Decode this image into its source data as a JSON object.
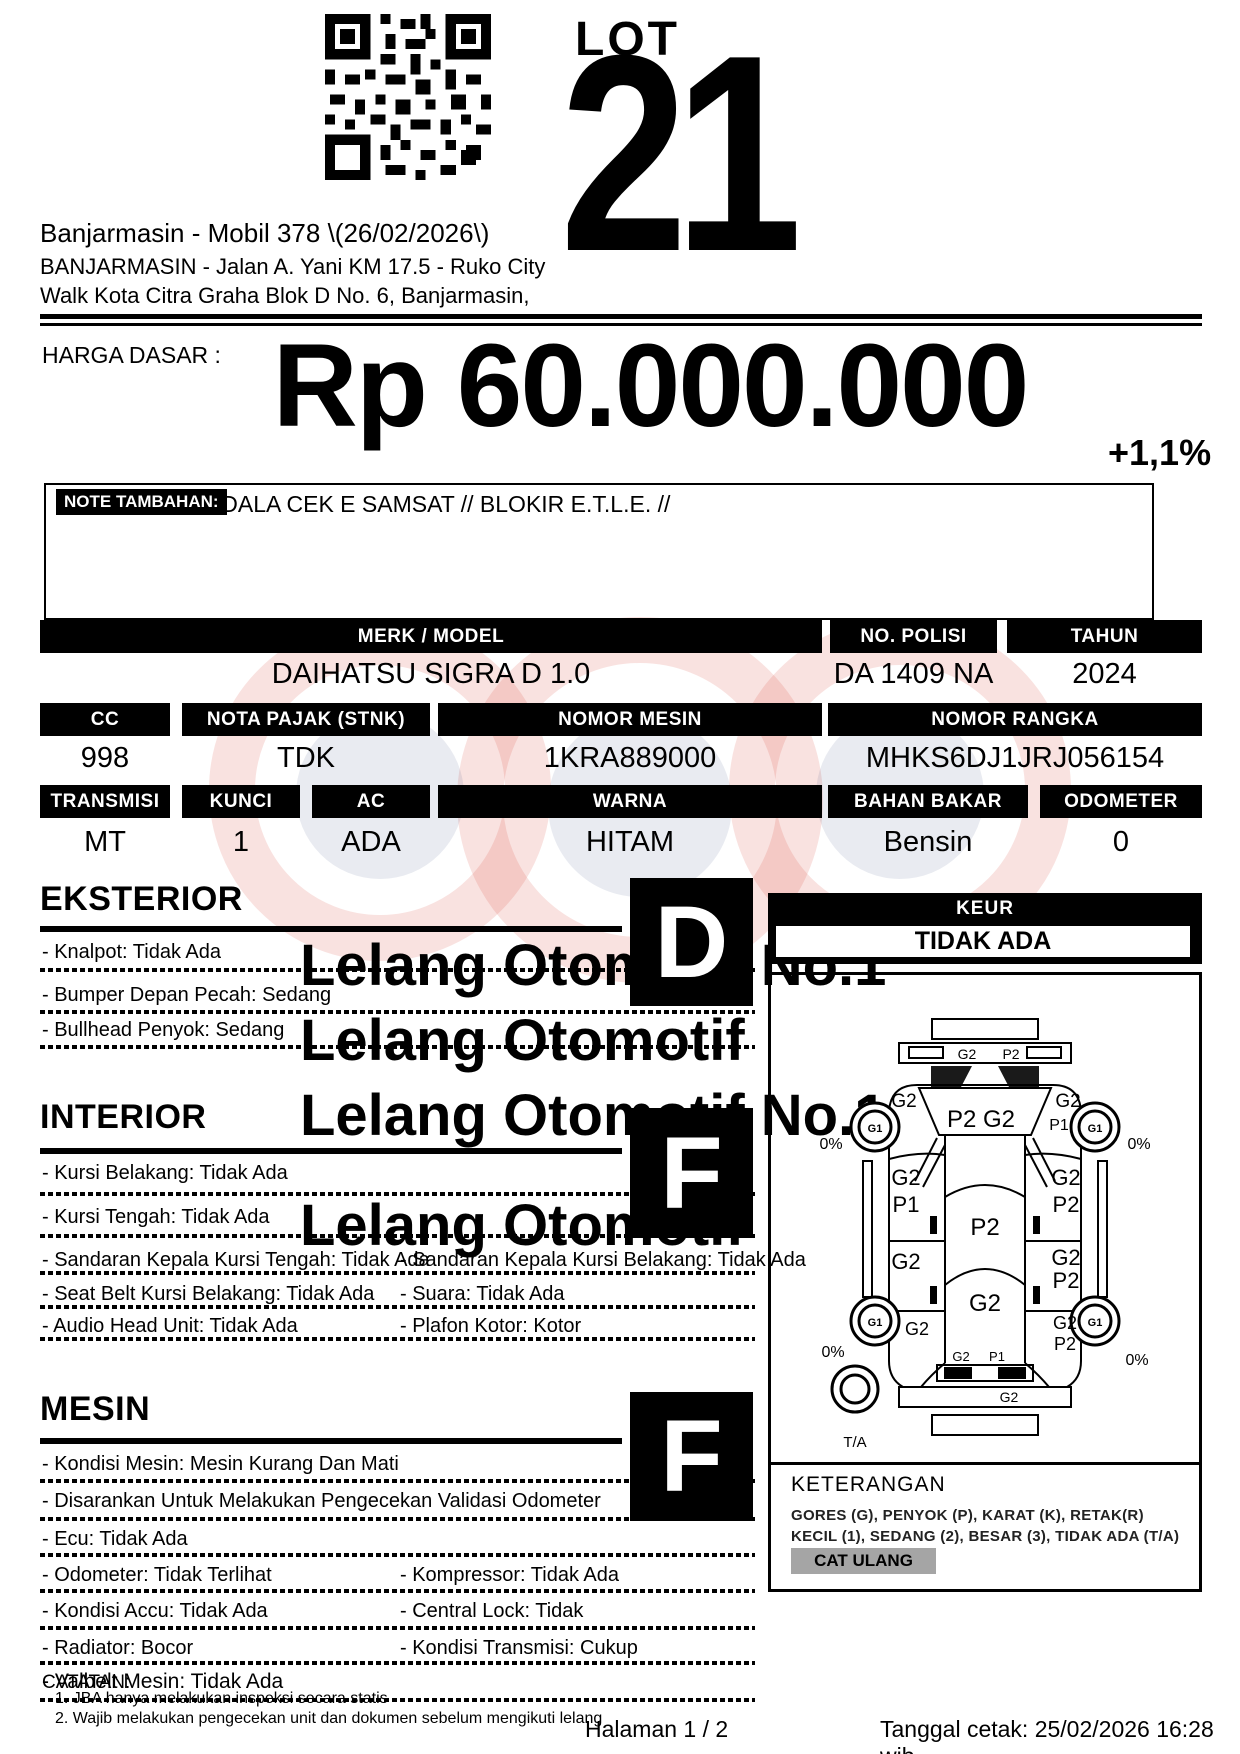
{
  "header": {
    "lot_label": "LOT",
    "lot_number": "21",
    "auction_title": "Banjarmasin - Mobil 378 \\(26/02/2026\\)",
    "address_line1": "BANJARMASIN - Jalan A. Yani KM 17.5 - Ruko City",
    "address_line2": "Walk Kota Citra Graha Blok D No. 6, Banjarmasin,"
  },
  "price": {
    "label": "HARGA DASAR :",
    "amount": "Rp 60.000.000",
    "increment": "+1,1%"
  },
  "note": {
    "label": "NOTE TAMBAHAN:",
    "text": "KENDALA CEK E SAMSAT // BLOKIR E.T.L.E. //"
  },
  "specs": {
    "merk_label": "MERK / MODEL",
    "merk_value": "DAIHATSU SIGRA D 1.0",
    "nopol_label": "NO. POLISI",
    "nopol_value": "DA 1409 NA",
    "tahun_label": "TAHUN",
    "tahun_value": "2024",
    "cc_label": "CC",
    "cc_value": "998",
    "pajak_label": "NOTA PAJAK (STNK)",
    "pajak_value": "TDK",
    "mesin_label": "NOMOR MESIN",
    "mesin_value": "1KRA889000",
    "rangka_label": "NOMOR RANGKA",
    "rangka_value": "MHKS6DJ1JRJ056154",
    "transmisi_label": "TRANSMISI",
    "transmisi_value": "MT",
    "kunci_label": "KUNCI",
    "kunci_value": "1",
    "ac_label": "AC",
    "ac_value": "ADA",
    "warna_label": "WARNA",
    "warna_value": "HITAM",
    "bahan_label": "BAHAN BAKAR",
    "bahan_value": "Bensin",
    "odo_label": "ODOMETER",
    "odo_value": "0"
  },
  "keur": {
    "label": "KEUR",
    "value": "TIDAK ADA"
  },
  "sections": {
    "eksterior": {
      "title": "EKSTERIOR",
      "grade": "D",
      "items": [
        "- Knalpot: Tidak Ada",
        "- Bumper Depan Pecah: Sedang",
        "- Bullhead Penyok: Sedang"
      ]
    },
    "interior": {
      "title": "INTERIOR",
      "grade": "F",
      "items_full": [
        "- Kursi Belakang: Tidak Ada",
        "- Kursi Tengah: Tidak Ada"
      ],
      "rows": [
        [
          "- Sandaran Kepala Kursi Tengah: Tidak Ada",
          "- Sandaran Kepala Kursi Belakang: Tidak Ada"
        ],
        [
          "- Seat Belt Kursi Belakang: Tidak Ada",
          "- Suara: Tidak Ada"
        ],
        [
          "- Audio Head Unit: Tidak Ada",
          "- Plafon Kotor: Kotor"
        ]
      ]
    },
    "mesin": {
      "title": "MESIN",
      "grade": "F",
      "items_full": [
        "- Kondisi Mesin: Mesin Kurang Dan Mati",
        "- Disarankan Untuk Melakukan Pengecekan Validasi Odometer",
        "- Ecu: Tidak Ada"
      ],
      "rows": [
        [
          "- Odometer: Tidak Terlihat",
          "- Kompressor: Tidak Ada"
        ],
        [
          "- Kondisi Accu: Tidak Ada",
          "- Central Lock: Tidak"
        ],
        [
          "- Radiator: Bocor",
          "- Kondisi Transmisi: Cukup"
        ]
      ]
    }
  },
  "diagram": {
    "rear_bumper_g": "G2",
    "rear_bumper_p": "P2",
    "quarter_left": "G2",
    "quarter_right": "G2",
    "quarter_right_p": "P1",
    "rear_glass": "P2 G2",
    "wheel_code": "G1",
    "tread": "0%",
    "rear_door_left_g": "G2",
    "rear_door_left_p": "P1",
    "rear_door_right_g": "G2",
    "rear_door_right_p": "P2",
    "roof": "P2",
    "front_door_left_g": "G2",
    "front_door_right_g": "G2",
    "front_door_right_p": "P2",
    "hood": "G2",
    "fender_left_g": "G2",
    "fender_right_g": "G2",
    "fender_right_p": "P2",
    "front_row_g": "G2",
    "front_row_p": "P1",
    "front_bumper": "G2",
    "spare": "T/A"
  },
  "keterangan": {
    "title": "KETERANGAN",
    "line1": "GORES (G), PENYOK (P), KARAT (K), RETAK(R)",
    "line2": "KECIL (1), SEDANG (2), BESAR (3), TIDAK ADA (T/A)",
    "badge": "CAT ULANG"
  },
  "footer": {
    "catatan_label": "CATATAN:",
    "valbelt_item": "- Valbelt Mesin: Tidak Ada",
    "note1": "1. JBA hanya melakukan inspeksi secara statis",
    "note2": "2. Wajib melakukan pengecekan unit dan dokumen sebelum mengikuti lelang",
    "page": "Halaman 1 / 2",
    "printed": "Tanggal cetak: 25/02/2026 16:28 wib"
  },
  "watermark": {
    "line1": "Lelang Otomotif No.1",
    "line2": "Lelang Otomotif"
  },
  "colors": {
    "ink": "#000000",
    "badge_gray": "#a5a5a5",
    "wm_red": "#d63c32",
    "wm_blue": "#28376f"
  }
}
